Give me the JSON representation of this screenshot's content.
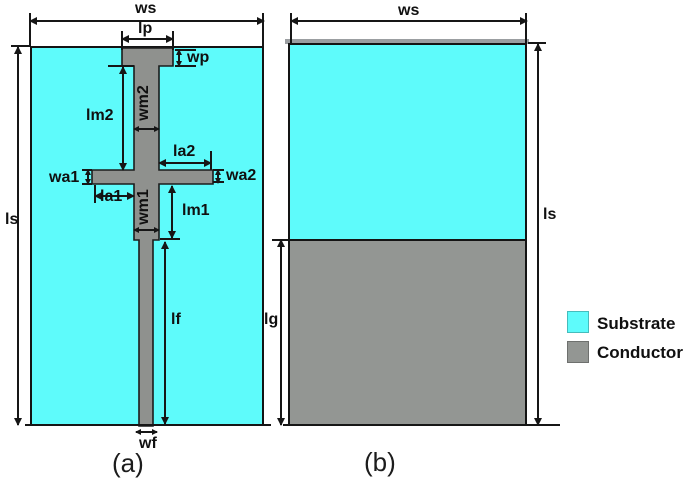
{
  "panel_a": {
    "caption": "(a)",
    "dims": {
      "ws": "ws",
      "lp": "lp",
      "wp": "wp",
      "wm2": "wm2",
      "lm2": "lm2",
      "la2": "la2",
      "wa1": "wa1",
      "wa2": "wa2",
      "la1": "la1",
      "wm1": "wm1",
      "lm1": "lm1",
      "ls": "ls",
      "lf": "lf",
      "wf": "wf"
    }
  },
  "panel_b": {
    "caption": "(b)",
    "dims": {
      "ws": "ws",
      "ls": "ls",
      "lg": "lg"
    }
  },
  "legend": {
    "items": [
      {
        "label": "Substrate",
        "color": "#5EFBFB"
      },
      {
        "label": "Conductor",
        "color": "#939693"
      }
    ]
  },
  "colors": {
    "substrate": "#5EFBFB",
    "conductor_front": "#8F918E",
    "conductor_back": "#939693",
    "outline": "#141414"
  }
}
